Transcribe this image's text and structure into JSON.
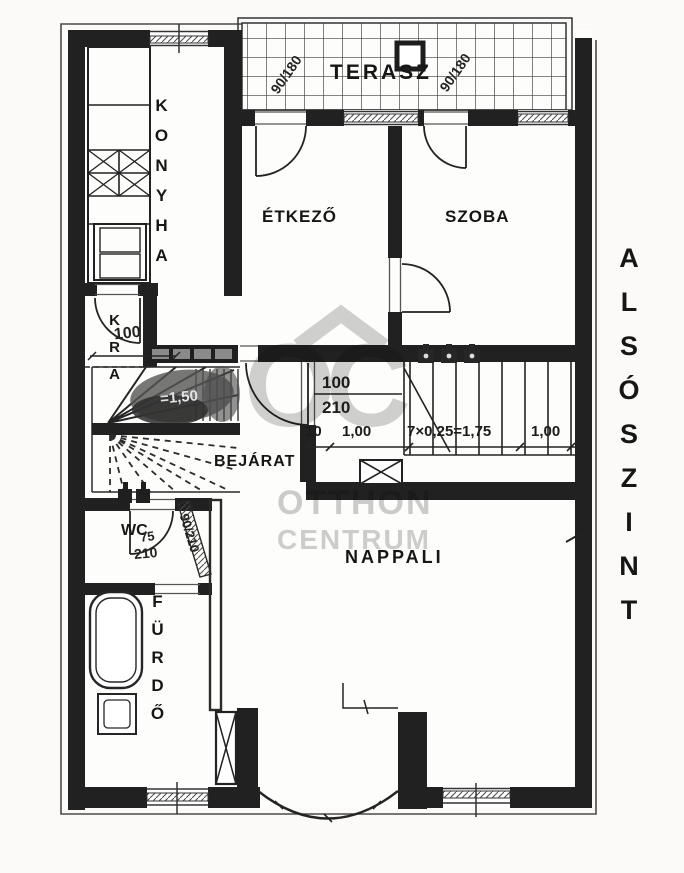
{
  "floorplan": {
    "level_label": "ALSÓSZINT",
    "rooms": {
      "terasz": "TERASZ",
      "konyha": "KONYHA",
      "etkezo": "ÉTKEZŐ",
      "szoba": "SZOBA",
      "kamra": "KRA",
      "bejarat": "BEJÁRAT",
      "wc": "WC",
      "furdo": "FÜRDŐ",
      "nappali": "NAPPALI"
    },
    "dimensions": {
      "terasz_door_left": "90/180",
      "terasz_door_right": "90/180",
      "stair_door_width": "100",
      "stair_door_height": "210",
      "landing_offset": "10",
      "landing_width": "1,00",
      "stair_run": "7×0,25=1,75",
      "stair_width": "1,00",
      "winder_width": "100",
      "winder_note": "=1,50",
      "wc_door_width": "75",
      "wc_door_height": "210",
      "hall_door": "90/210"
    },
    "watermark": {
      "logo": "OC",
      "line1": "OTTHON",
      "line2": "CENTRUM"
    },
    "colors": {
      "ink": "#1f1f1f",
      "paper": "#fbfaf8",
      "watermark_gray": "#c8c8c8"
    }
  }
}
